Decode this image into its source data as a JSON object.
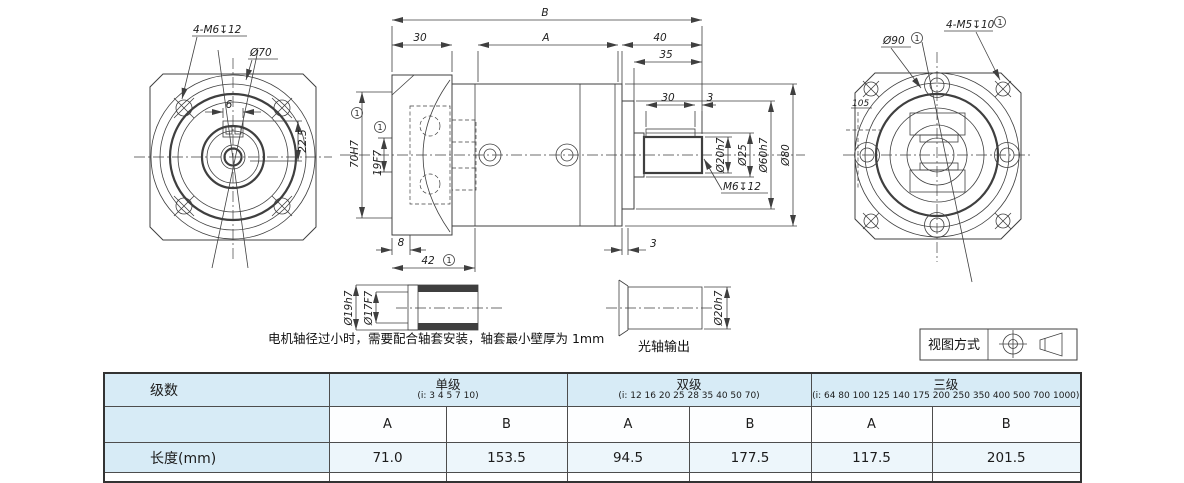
{
  "drawing": {
    "footnote": "1",
    "front": {
      "thread_label": "4-M6↧12",
      "pilot_dia": "Ø70",
      "key_width": "6",
      "keyway_dim": "22.5"
    },
    "side": {
      "overall_len": "B",
      "flange_th": "30",
      "body_len": "A",
      "out_len": "40",
      "dim_35": "35",
      "key_len": "30",
      "end_3": "3",
      "pilot_bore": "70H7",
      "input_bore": "19F7",
      "dim_8": "8",
      "dim_42": "42",
      "gap_3": "3",
      "shaft_dia": "Ø20h7",
      "collar_dia": "Ø25",
      "spigot_dia": "Ø60h7",
      "body_dia": "Ø80",
      "end_tap": "M6↧12"
    },
    "rear": {
      "pilot_dia": "Ø90",
      "thread_label": "4-M5↧10",
      "diag_dim": "105"
    },
    "sleeve": {
      "outer_dia": "Ø19h7",
      "inner_dia": "Ø17F7"
    },
    "note": "电机轴径过小时，需要配合轴套安装，轴套最小壁厚为 1mm",
    "shaft_out": {
      "dia": "Ø20h7",
      "label": "光轴输出"
    },
    "projection_label": "视图方式"
  },
  "table": {
    "row_header": "级数",
    "length_label": "长度(mm)",
    "col_a": "A",
    "col_b": "B",
    "groups": [
      {
        "name": "单级",
        "ratios": "(i: 3 4 5 7 10)",
        "a": "71.0",
        "b": "153.5"
      },
      {
        "name": "双级",
        "ratios": "(i: 12 16 20 25 28 35 40 50 70)",
        "a": "94.5",
        "b": "177.5"
      },
      {
        "name": "三级",
        "ratios": "(i: 64 80 100 125 140 175 200 250 350 400 500 700 1000)",
        "a": "117.5",
        "b": "201.5"
      }
    ]
  }
}
